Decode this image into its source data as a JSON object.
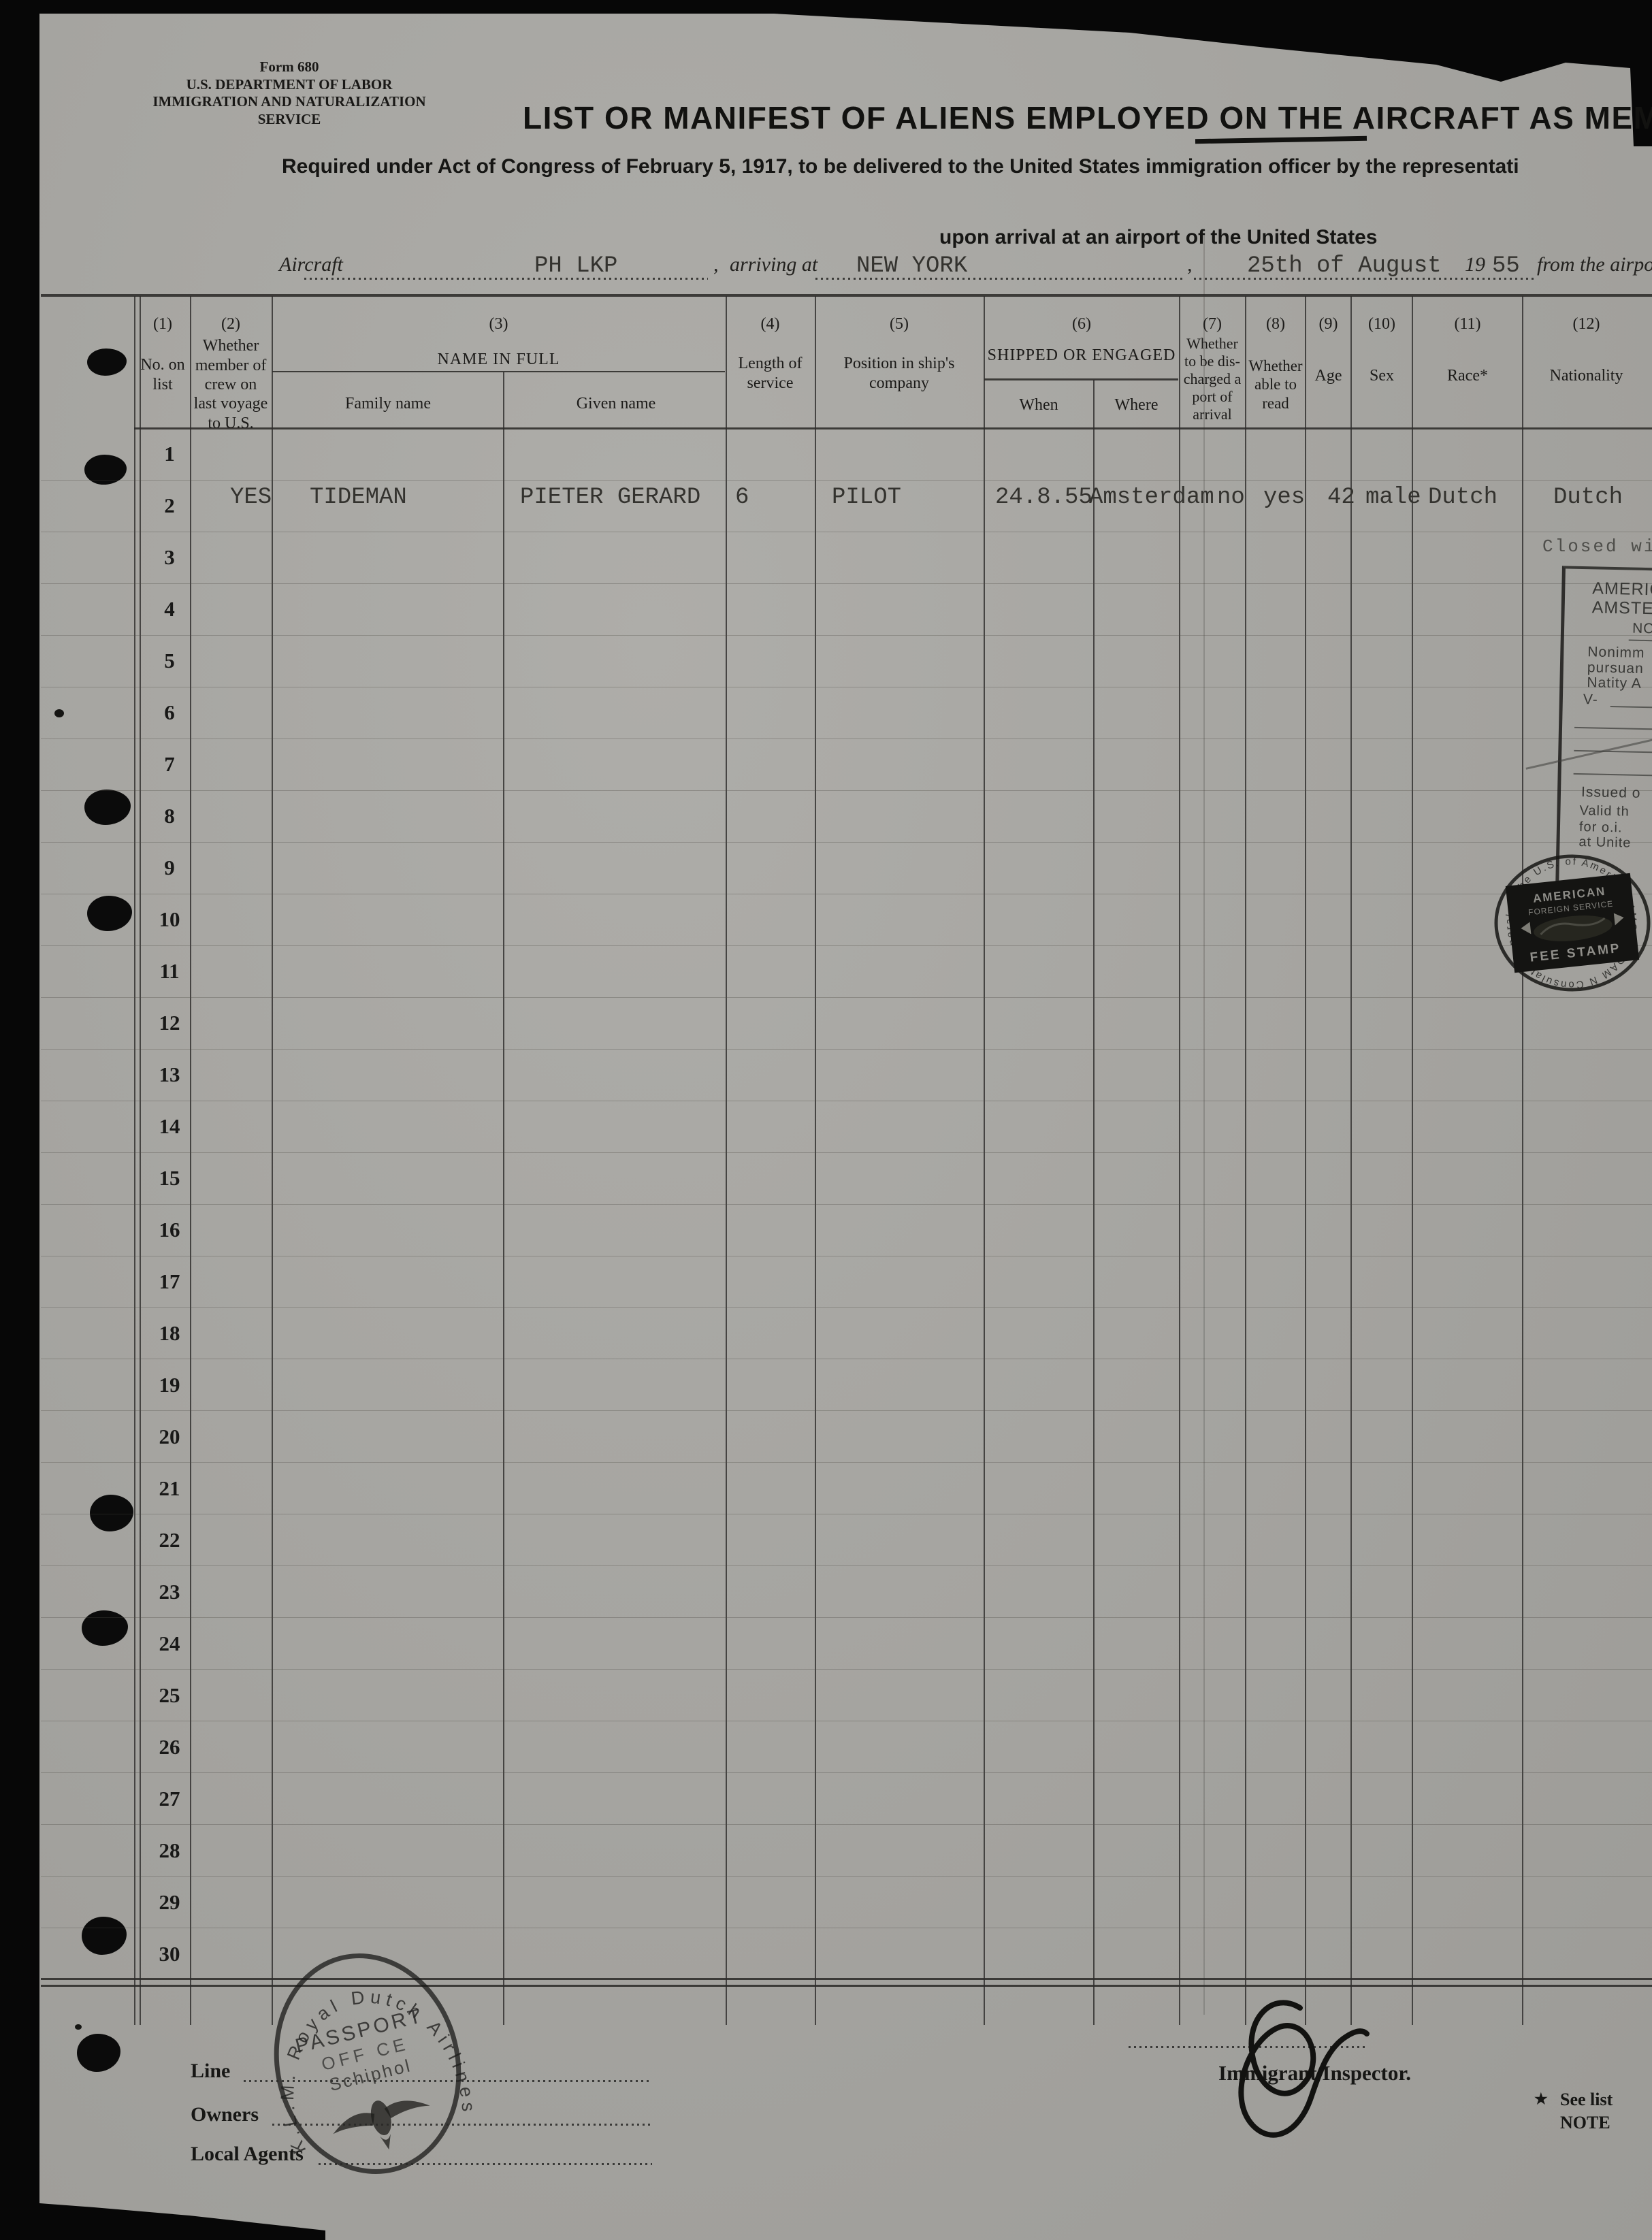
{
  "form": {
    "form_number": "Form 680",
    "department": "U.S. DEPARTMENT OF LABOR",
    "service": "IMMIGRATION AND NATURALIZATION SERVICE",
    "title": "LIST OR MANIFEST OF ALIENS EMPLOYED ON THE AIRCRAFT AS MEM",
    "subtitle_line1": "Required under Act of Congress of February 5, 1917, to be delivered to the United States immigration officer by the representati",
    "subtitle_line2": "upon arrival at an airport of the United States"
  },
  "arrival": {
    "aircraft_label": "Aircraft",
    "aircraft_value": "PH LKP",
    "comma1": ",",
    "arriving_at_label": "arriving at",
    "arriving_at_value": "NEW YORK",
    "comma2": ",",
    "date_value": "25th of August",
    "year_prefix": "19",
    "year_value": "55",
    "from_label": "from the airpo"
  },
  "table": {
    "columns": [
      {
        "num": "(1)",
        "label": "No. on list"
      },
      {
        "num": "(2)",
        "label": "Whether member of crew on last voyage to U.S."
      },
      {
        "num": "(3)",
        "label": "NAME IN FULL",
        "sub1": "Family name",
        "sub2": "Given name"
      },
      {
        "num": "(4)",
        "label": "Length of service"
      },
      {
        "num": "(5)",
        "label": "Position in ship's company"
      },
      {
        "num": "(6)",
        "label": "SHIPPED OR ENGAGED",
        "sub1": "When",
        "sub2": "Where"
      },
      {
        "num": "(7)",
        "label": "Whether to be dis-charged a port of arrival"
      },
      {
        "num": "(8)",
        "label": "Whether able to read"
      },
      {
        "num": "(9)",
        "label": "Age"
      },
      {
        "num": "(10)",
        "label": "Sex"
      },
      {
        "num": "(11)",
        "label": "Race*"
      },
      {
        "num": "(12)",
        "label": "Nationality"
      }
    ],
    "row_numbers": [
      1,
      2,
      3,
      4,
      5,
      6,
      7,
      8,
      9,
      10,
      11,
      12,
      13,
      14,
      15,
      16,
      17,
      18,
      19,
      20,
      21,
      22,
      23,
      24,
      25,
      26,
      27,
      28,
      29,
      30
    ],
    "entry": {
      "crew_member": "YES",
      "family_name": "TIDEMAN",
      "given_name": "PIETER GERARD",
      "length_of_service": "6",
      "position": "PILOT",
      "shipped_when": "24.8.55",
      "shipped_where": "Amsterdam",
      "discharged": "no",
      "able_to_read": "yes",
      "age": "42",
      "sex": "male",
      "race": "Dutch",
      "nationality": "Dutch"
    },
    "closed_note": "Closed wit"
  },
  "visa_stamp": {
    "line1": "AMERIC",
    "line2": "AMSTER",
    "line3": "NO",
    "line4": "Nonimm",
    "line5": "pursuan",
    "line6": "Natity A",
    "line7": "V-",
    "issued": "Issued o",
    "valid": "Valid th",
    "for_line": "for o.i.",
    "at_line": "at Unite"
  },
  "fee_stamp": {
    "circular_text": "Consulate General of the U.S. of America · AMSTERDAM NEDERLAND ·",
    "label_top1": "AMERICAN",
    "label_top2": "FOREIGN SERVICE",
    "label_bottom": "FEE STAMP"
  },
  "klm_stamp": {
    "arc_text": "K.L.M. Royal Dutch Airlines",
    "line1": "PASSPORT",
    "line2": "OFF CE",
    "line3": "Schiphol"
  },
  "footer": {
    "line_label": "Line",
    "owners_label": "Owners",
    "local_agents_label": "Local Agents",
    "inspector_label": "Immigrant Inspector.",
    "note_star": "★",
    "note_line1": "See list",
    "note_line2": "NOTE"
  }
}
